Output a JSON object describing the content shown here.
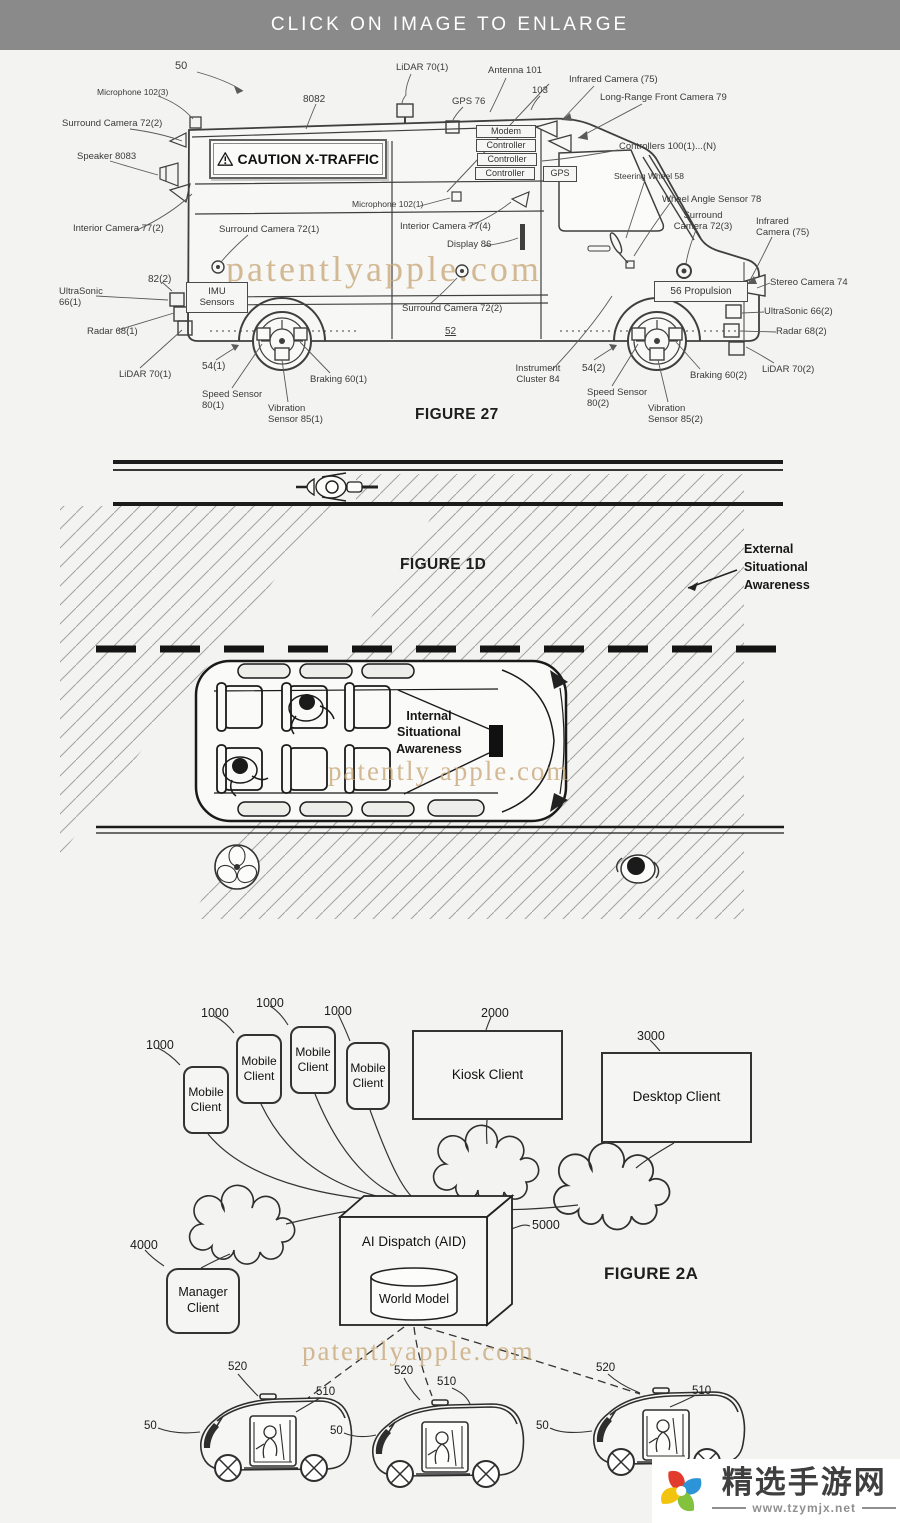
{
  "header": {
    "title": "CLICK ON IMAGE TO ENLARGE"
  },
  "fig27": {
    "caption": "FIGURE 27",
    "watermark": "patentlyapple.com",
    "sign_text": "CAUTION X-TRAFFIC",
    "boxes": {
      "modem": "Modem",
      "controller1": "Controller",
      "controller2": "Controller",
      "controller3": "Controller",
      "gps": "GPS",
      "imu": "IMU\nSensors",
      "propulsion": "56  Propulsion"
    },
    "labels": [
      "50",
      "Microphone 102(3)",
      "8082",
      "LiDAR 70(1)",
      "Antenna 101",
      "GPS 76",
      "103",
      "Infrared Camera (75)",
      "Long-Range Front Camera 79",
      "Surround Camera 72(2)",
      "Controllers 100(1)...(N)",
      "Speaker 8083",
      "Steering Wheel 58",
      "Wheel Angle Sensor 78",
      "Surround\nCamera 72(3)",
      "Infrared\nCamera (75)",
      "Interior Camera 77(2)",
      "Microphone 102(1)",
      "Surround Camera 72(1)",
      "Interior Camera 77(4)",
      "Display 86",
      "Stereo Camera 74",
      "UltraSonic 66(2)",
      "Radar 68(2)",
      "LiDAR 70(2)",
      "82(2)",
      "UltraSonic\n66(1)",
      "Radar 68(1)",
      "LiDAR 70(1)",
      "54(1)",
      "Speed Sensor\n80(1)",
      "Vibration\nSensor 85(1)",
      "Braking 60(1)",
      "Surround Camera 72(2)",
      "52",
      "Instrument\nCluster 84",
      "54(2)",
      "Speed Sensor\n80(2)",
      "Vibration\nSensor 85(2)",
      "Braking 60(2)"
    ]
  },
  "fig1d": {
    "caption": "FIGURE 1D",
    "watermark": "patently apple.com",
    "external": "External\nSituational\nAwareness",
    "internal": "Internal\nSituational\nAwareness"
  },
  "fig2a": {
    "caption": "FIGURE 2A",
    "watermark": "patentlyapple.com",
    "mobile_client": "Mobile\nClient",
    "kiosk_client": "Kiosk Client",
    "desktop_client": "Desktop Client",
    "manager_client": "Manager\nClient",
    "ai_dispatch": "AI Dispatch (AID)",
    "world_model": "World Model",
    "refs": {
      "mobile": "1000",
      "kiosk": "2000",
      "desktop": "3000",
      "manager": "4000",
      "aid": "5000",
      "vehicle": "50",
      "v510": "510",
      "v520": "520"
    }
  },
  "logo": {
    "site_name": "精选手游网",
    "site_url": "www.tzymjx.net"
  }
}
